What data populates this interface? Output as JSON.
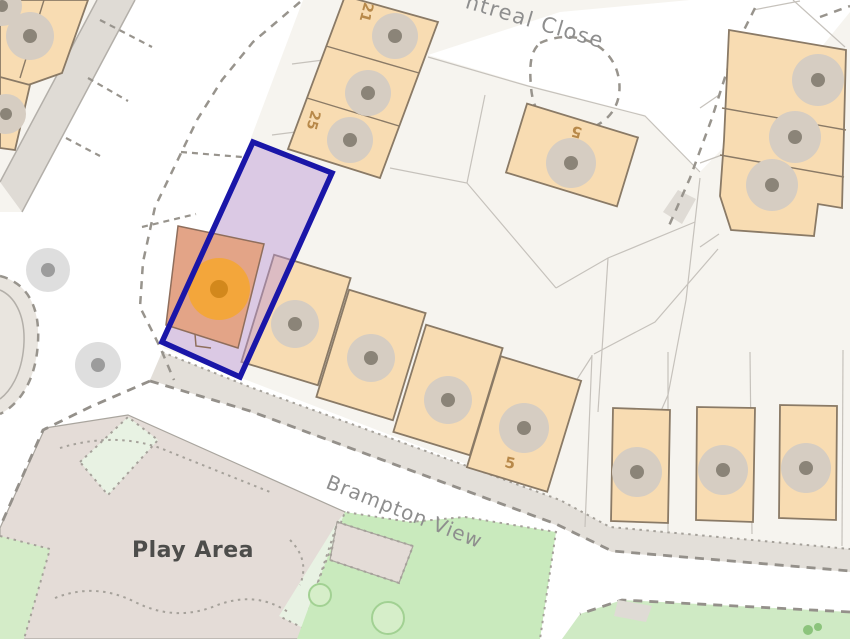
{
  "title": "Property location map",
  "labels": {
    "street_top": "ntreal Close",
    "street_main": "Brampton View",
    "play_area": "Play Area",
    "house_21": "21",
    "house_25": "25",
    "house_5_top": "5",
    "house_5_row": "5"
  },
  "highlight": {
    "type": "selected-plot-boundary",
    "border_color": "#1a16a8",
    "fill_color": "rgba(186,149,214,0.45)",
    "marker_color": "#f3a63b",
    "marker_dot_color": "#d2881c",
    "selected_building_fill": "#e3a487"
  },
  "map_colors": {
    "building_fill": "#f8dcb2",
    "building_stroke": "#8a7a66",
    "tree_fill": "#d6cdc2",
    "tree_dot": "#8b8478",
    "parcel_background": "#f6f4ef",
    "road": "#ffffff",
    "sidewalk": "#e3dfd9",
    "play_area_fill": "#e4dcd7",
    "green": "#c9eabd",
    "mint": "#e8f2e3",
    "street_label": "#8e8e8e",
    "number_label": "#b8894a",
    "dashed_line": "#98948d"
  }
}
